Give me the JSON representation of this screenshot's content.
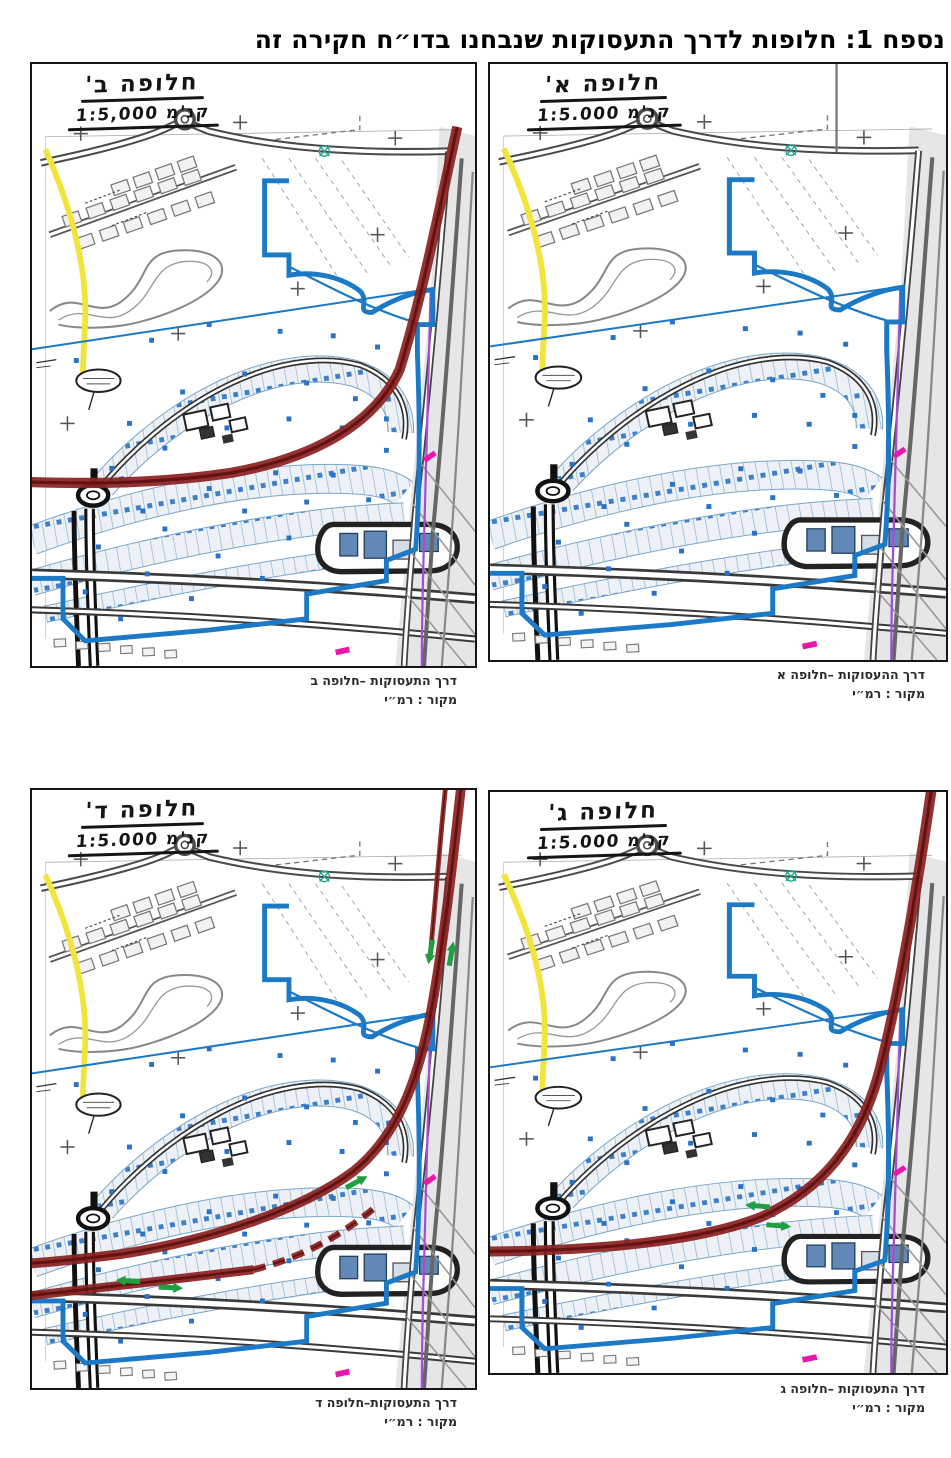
{
  "page": {
    "title": "נספח 1: חלופות לדרך התעסוקות שנבחנו בדו״ח חקירה זה"
  },
  "panels": [
    {
      "key": "alt-b",
      "variant": "B",
      "handwritten_title": "חלופה ב'",
      "handwritten_scale": "קנ'מ 1:5,000",
      "caption_line1": "דרך התעסוקות –חלופה ב",
      "caption_line2": "מקור : רמ״י"
    },
    {
      "key": "alt-a",
      "variant": "A",
      "handwritten_title": "חלופה א'",
      "handwritten_scale": "קנ'מ 1:5.000",
      "caption_line1": "דרך ההעסוקות –חלופה א",
      "caption_line2": "מקור : רמ״י"
    },
    {
      "key": "alt-d",
      "variant": "D",
      "handwritten_title": "חלופה ד'",
      "handwritten_scale": "קנ'מ 1:5.000",
      "caption_line1": "דרך התעסוקות–חלופה ד",
      "caption_line2": "מקור : רמ״י"
    },
    {
      "key": "alt-c",
      "variant": "C",
      "handwritten_title": "חלופה ג'",
      "handwritten_scale": "קנ'מ 1:5.000",
      "caption_line1": "דרך התעסוקות –חלופה ג",
      "caption_line2": "מקור : רמ״י"
    }
  ],
  "map_colors": {
    "alternative_road": "#8c2121",
    "plan_boundary": "#1b79c6",
    "existing_route_yellow": "#f1e43c",
    "rail_line_purple": "#a44fd2",
    "marker_magenta": "#e718aa",
    "direction_arrow_green": "#1f9e42",
    "lot_dot_blue": "#2a72c4"
  }
}
